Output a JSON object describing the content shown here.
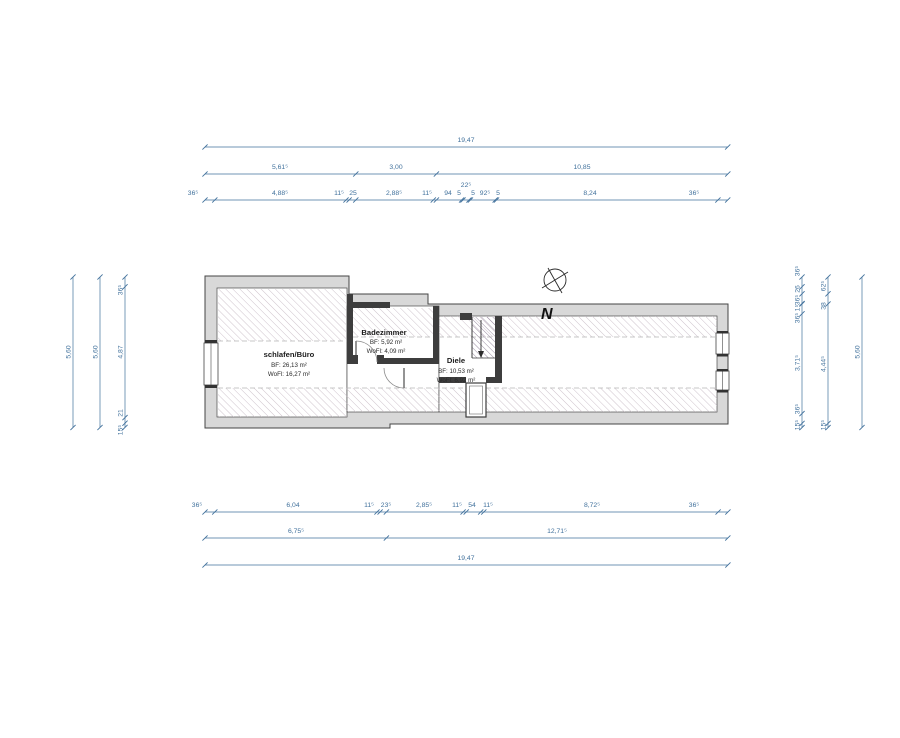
{
  "document": {
    "type": "architectural-floor-plan",
    "background": "#ffffff"
  },
  "colors": {
    "dimension_blue": "#41719c",
    "wall_fill": "#d8d8d8",
    "wall_stroke": "#454545",
    "partition": "#3d3d3d",
    "hatch_room": "#c9bcc6",
    "hatch_stair": "#8f8098",
    "dashed_line": "#b5b5b5"
  },
  "rooms": [
    {
      "name": "schlafen/Büro",
      "bf": "BF: 26,13 m²",
      "wofl": "WoFl: 16,27 m²"
    },
    {
      "name": "Badezimmer",
      "bf": "BF: 5,92 m²",
      "wofl": "WoFl: 4,09 m²"
    },
    {
      "name": "Diele",
      "bf": "BF: 10,53 m²",
      "wofl": "WoFl: 6,92 m²"
    }
  ],
  "north_label": "N",
  "horizontal_dims": [
    {
      "name": "top-overall",
      "y": 147,
      "x1": 205,
      "x2": 727.7,
      "ticks": [
        205,
        727.7
      ],
      "labels": [
        {
          "t": "19,47",
          "x": 466,
          "y": 142
        }
      ]
    },
    {
      "name": "top-mid",
      "y": 174,
      "x1": 205,
      "x2": 727.8,
      "ticks": [
        205,
        355.8,
        436.4,
        727.8
      ],
      "labels": [
        {
          "t": "5,61⁵",
          "x": 280,
          "y": 169
        },
        {
          "t": "3,00",
          "x": 396,
          "y": 169
        },
        {
          "t": "10,85",
          "x": 582,
          "y": 169
        }
      ]
    },
    {
      "name": "top-detail",
      "y": 200,
      "x1": 205,
      "x2": 727.7,
      "ticks": [
        205,
        214.8,
        346,
        349.1,
        355.8,
        433.3,
        436.4,
        461.6,
        463,
        469,
        470.4,
        495.2,
        496.5,
        717.9,
        727.7
      ],
      "labels": [
        {
          "t": "36⁵",
          "x": 193,
          "y": 195
        },
        {
          "t": "4,88⁵",
          "x": 280,
          "y": 195
        },
        {
          "t": "11⁵",
          "x": 339,
          "y": 195
        },
        {
          "t": "25",
          "x": 353,
          "y": 195
        },
        {
          "t": "2,88⁵",
          "x": 394,
          "y": 195
        },
        {
          "t": "11⁵",
          "x": 427,
          "y": 195
        },
        {
          "t": "94",
          "x": 448,
          "y": 195
        },
        {
          "t": "5",
          "x": 459,
          "y": 195
        },
        {
          "t": "22⁵",
          "x": 466,
          "y": 187
        },
        {
          "t": "5",
          "x": 473,
          "y": 195
        },
        {
          "t": "92⁵",
          "x": 485,
          "y": 195
        },
        {
          "t": "5",
          "x": 498,
          "y": 195
        },
        {
          "t": "8,24",
          "x": 590,
          "y": 195
        },
        {
          "t": "36⁵",
          "x": 694,
          "y": 195
        }
      ]
    },
    {
      "name": "bottom-detail",
      "y": 512,
      "x1": 205,
      "x2": 727.9,
      "ticks": [
        205,
        214.8,
        377,
        380.1,
        386.4,
        463.1,
        466.2,
        480.7,
        483.8,
        718.1,
        727.9
      ],
      "labels": [
        {
          "t": "36⁵",
          "x": 197,
          "y": 507
        },
        {
          "t": "6,04",
          "x": 293,
          "y": 507
        },
        {
          "t": "11⁵",
          "x": 369,
          "y": 507
        },
        {
          "t": "23⁵",
          "x": 386,
          "y": 507
        },
        {
          "t": "2,85⁵",
          "x": 424,
          "y": 507
        },
        {
          "t": "11⁵",
          "x": 457,
          "y": 507
        },
        {
          "t": "54",
          "x": 472,
          "y": 507
        },
        {
          "t": "11⁵",
          "x": 488,
          "y": 507
        },
        {
          "t": "8,72⁵",
          "x": 592,
          "y": 507
        },
        {
          "t": "36⁵",
          "x": 694,
          "y": 507
        }
      ]
    },
    {
      "name": "bottom-mid",
      "y": 538,
      "x1": 205,
      "x2": 727.8,
      "ticks": [
        205,
        386.4,
        727.8
      ],
      "labels": [
        {
          "t": "6,75⁵",
          "x": 296,
          "y": 533
        },
        {
          "t": "12,71⁵",
          "x": 557,
          "y": 533
        }
      ]
    },
    {
      "name": "bottom-overall",
      "y": 565,
      "x1": 205,
      "x2": 727.9,
      "ticks": [
        205,
        727.9
      ],
      "labels": [
        {
          "t": "19,47",
          "x": 466,
          "y": 560
        }
      ]
    }
  ],
  "vertical_dims": [
    {
      "name": "left-outer",
      "x": 73,
      "y1": 277,
      "y2": 427.5,
      "ticks": [
        277,
        427.5
      ],
      "labels": [
        {
          "t": "5,60",
          "y": 352
        }
      ]
    },
    {
      "name": "left-mid",
      "x": 100,
      "y1": 277,
      "y2": 427.5,
      "ticks": [
        277,
        427.5
      ],
      "labels": [
        {
          "t": "5,60",
          "y": 352
        }
      ]
    },
    {
      "name": "left-detail",
      "x": 125,
      "y1": 277,
      "y2": 427.4,
      "ticks": [
        277,
        286.8,
        417.6,
        423.2,
        427.4
      ],
      "labels": [
        {
          "t": "36⁵",
          "y": 290
        },
        {
          "t": "4,87",
          "y": 352
        },
        {
          "t": "21",
          "y": 413
        },
        {
          "t": "15⁵",
          "y": 430
        }
      ]
    },
    {
      "name": "right-detail",
      "x": 802,
      "y1": 277,
      "y2": 427.6,
      "ticks": [
        277,
        286.8,
        293.8,
        303.6,
        304,
        313.8,
        413.6,
        423.4,
        427.6
      ],
      "labels": [
        {
          "t": "36⁵",
          "y": 271
        },
        {
          "t": "26",
          "y": 289
        },
        {
          "t": "36⁵",
          "y": 300
        },
        {
          "t": "1⁵",
          "y": 308
        },
        {
          "t": "36⁵",
          "y": 318
        },
        {
          "t": "3,71⁵",
          "y": 363
        },
        {
          "t": "36⁵",
          "y": 409
        },
        {
          "t": "15⁵",
          "y": 425
        }
      ]
    },
    {
      "name": "right-mid",
      "x": 828,
      "y1": 277,
      "y2": 427.6,
      "ticks": [
        277,
        293.8,
        304,
        423.4,
        427.6
      ],
      "labels": [
        {
          "t": "62⁵",
          "y": 286
        },
        {
          "t": "38",
          "y": 306
        },
        {
          "t": "4,44⁵",
          "y": 364
        },
        {
          "t": "15⁵",
          "y": 425
        }
      ]
    },
    {
      "name": "right-outer",
      "x": 862,
      "y1": 277,
      "y2": 427.5,
      "ticks": [
        277,
        427.5
      ],
      "labels": [
        {
          "t": "5,60",
          "y": 352
        }
      ]
    }
  ]
}
